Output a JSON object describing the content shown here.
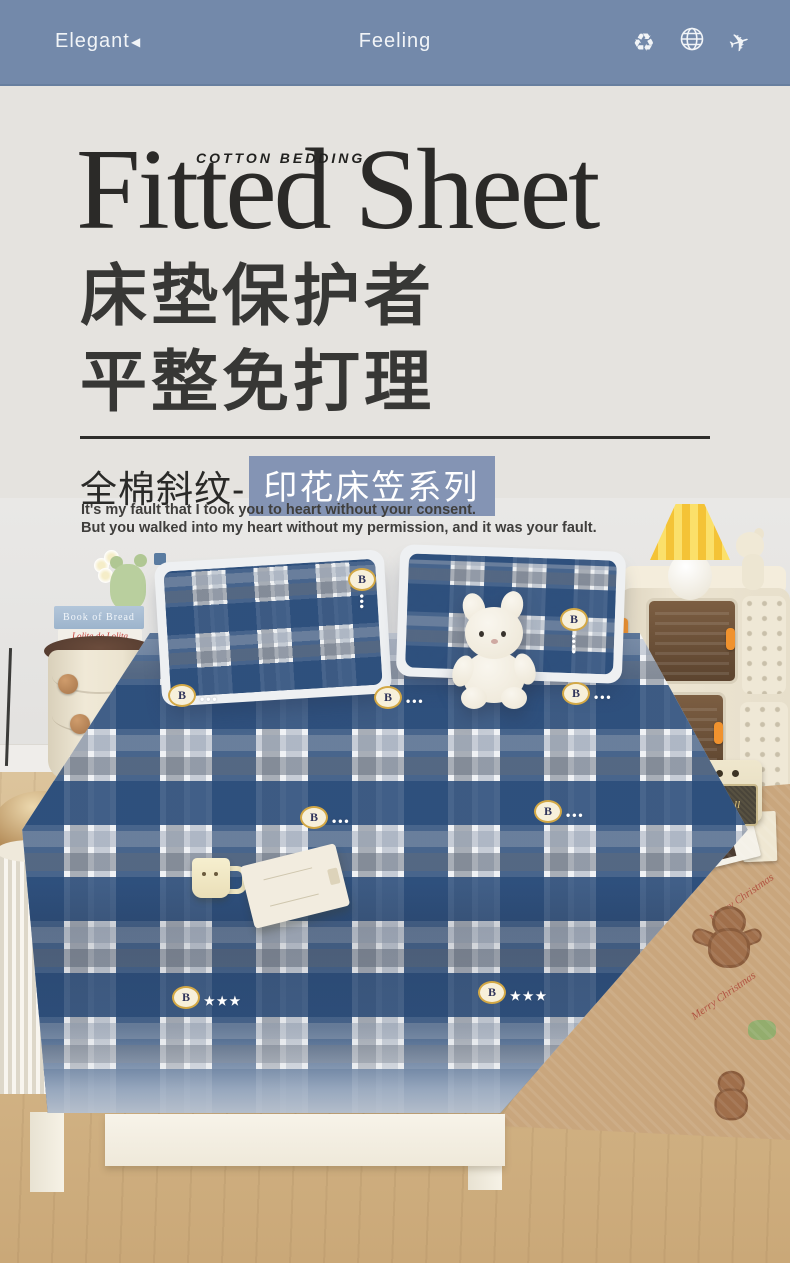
{
  "header": {
    "brand": "Elegant",
    "back_glyph": "◀",
    "center_title": "Feeling",
    "bg_color": "#7389aa",
    "icons": {
      "names": [
        "recycle-icon",
        "globe-icon",
        "airplane-icon"
      ],
      "recycle_glyph": "♻",
      "plane_glyph": "✈"
    }
  },
  "hero": {
    "eyebrow": "COTTON  BEDDING",
    "title": "Fitted Sheet",
    "headline": [
      "床垫保护者",
      "平整免打理"
    ],
    "series_prefix": "全棉斜纹-",
    "series_highlight": "印花床笠系列",
    "highlight_bg": "#8494b4",
    "tagline": [
      "It's my fault that I took you to heart without your consent.",
      "But you walked into my heart without my permission, and it was your fault."
    ]
  },
  "photo": {
    "badge_letter": "B",
    "badges": [
      {
        "x": 348,
        "y": 70,
        "dir": "v",
        "tail": "•••"
      },
      {
        "x": 560,
        "y": 110,
        "dir": "v",
        "tail": "••••"
      },
      {
        "x": 168,
        "y": 186,
        "dir": "h",
        "tail": "•••"
      },
      {
        "x": 374,
        "y": 188,
        "dir": "h",
        "tail": "•••"
      },
      {
        "x": 562,
        "y": 184,
        "dir": "h",
        "tail": "•••"
      },
      {
        "x": 300,
        "y": 308,
        "dir": "h",
        "tail": "•••"
      },
      {
        "x": 534,
        "y": 302,
        "dir": "h",
        "tail": "•••"
      },
      {
        "x": 172,
        "y": 488,
        "dir": "h",
        "tail": "★★★"
      },
      {
        "x": 478,
        "y": 483,
        "dir": "h",
        "tail": "★★★"
      }
    ],
    "book_spine": "Book of Bread",
    "book_script": "Lolita de Lolita",
    "speaker_logo": "Marshall",
    "rug_text": "Merry Christmas",
    "plaid_colors": {
      "blue": "#3a608f",
      "gray": "#8b94a2",
      "light": "#b9c2cf",
      "white": "#f2f4f6"
    },
    "accent_orange": "#f0922e",
    "lamp_yellow": "#f2c64b"
  }
}
